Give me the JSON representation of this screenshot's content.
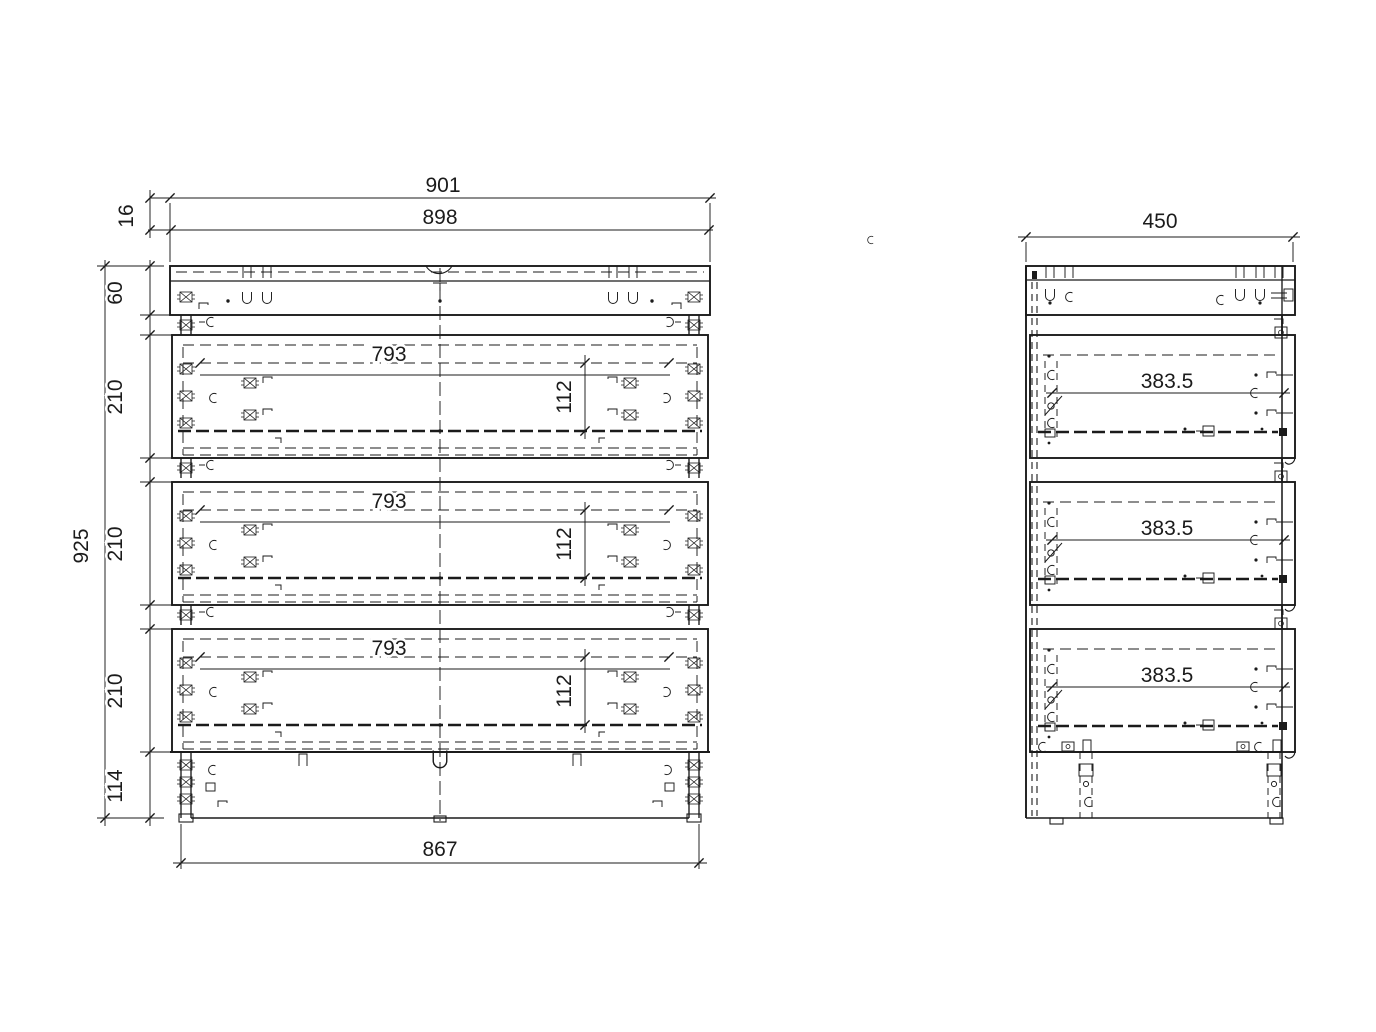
{
  "front": {
    "overall_width": "901",
    "carcass_width": "898",
    "top_panel_thickness": "16",
    "top_rail_height": "60",
    "drawer_heights": [
      "210",
      "210",
      "210"
    ],
    "overall_height": "925",
    "plinth_height": "114",
    "base_width": "867",
    "drawer_opening_widths": [
      "793",
      "793",
      "793"
    ],
    "drawer_inner_heights": [
      "112",
      "112",
      "112"
    ]
  },
  "side": {
    "overall_depth": "450",
    "drawer_inner_depths": [
      "383.5",
      "383.5",
      "383.5"
    ]
  }
}
